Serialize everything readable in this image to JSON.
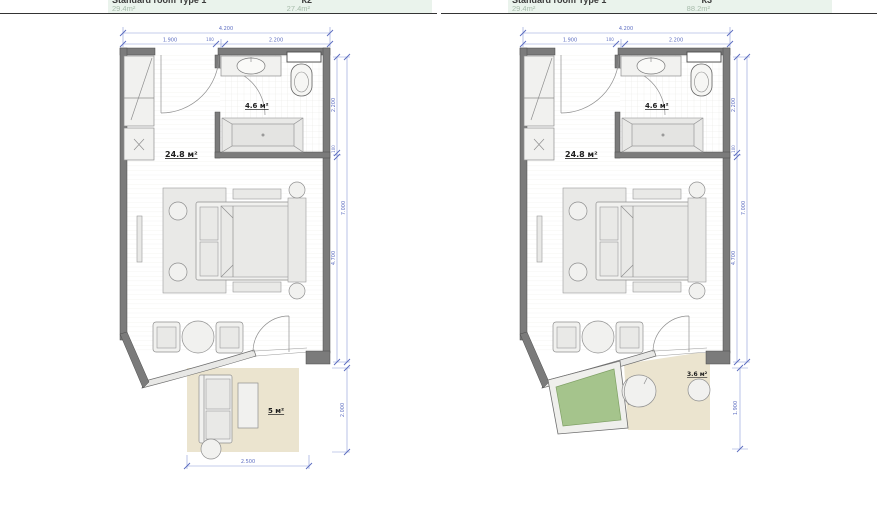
{
  "headers": {
    "left": {
      "title": "Standard room Type 1",
      "code": "К2",
      "area_left": "29.4m²",
      "area_right": "27.4m²"
    },
    "right": {
      "title": "Standard room Type 1",
      "code": "К3",
      "area_left": "29.4m²",
      "area_right": "88.2m²"
    }
  },
  "plans": {
    "left": {
      "room_area": "24.8 м²",
      "bath_area": "4.6 м²",
      "terrace_area": "5 м²",
      "dims": {
        "top_total": "4.200",
        "top_left": "1.900",
        "top_gap": "100",
        "top_right": "2.200",
        "side_top": "2.200",
        "side_gap": "100",
        "side_main": "4.700",
        "side_total": "7.000",
        "terrace_depth": "2.000",
        "terrace_width": "2.500"
      }
    },
    "right": {
      "room_area": "24.8 м²",
      "bath_area": "4.6 м²",
      "terrace_area": "3.6 м²",
      "dims": {
        "top_total": "4.200",
        "top_left": "1.900",
        "top_gap": "100",
        "top_right": "2.200",
        "side_top": "2.200",
        "side_gap": "100",
        "side_main": "4.700",
        "side_total": "7.000",
        "terrace_depth": "1.900"
      }
    }
  },
  "colors": {
    "wall": "#7b7b7b",
    "dimension_blue": "#5f6fc2",
    "terrace_beige": "#ebe4cf",
    "planter_green": "#a5c48c",
    "header_mint": "#eaf3ec",
    "furniture_fill": "#f1f1ef"
  }
}
